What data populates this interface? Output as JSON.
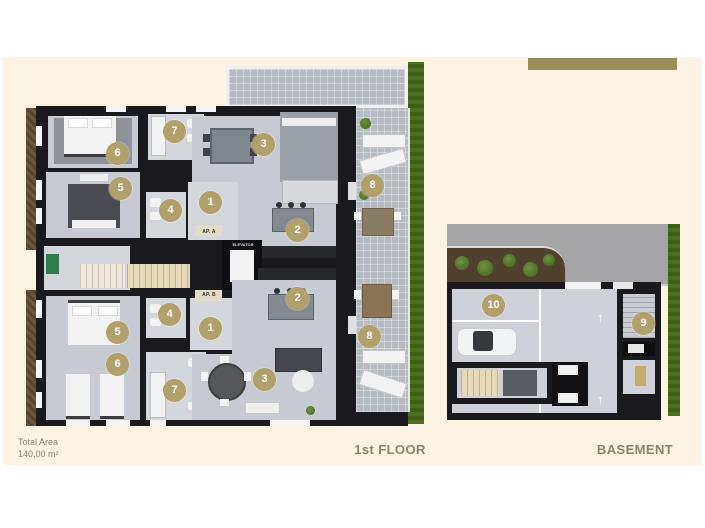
{
  "page": {
    "panel_color": "#fcf3e2",
    "accent_bar_color": "#9c8c5a",
    "marker_color": "#b1a06b"
  },
  "footer": {
    "total_area_label": "Total Area",
    "total_area_value": "140,00 m²"
  },
  "floor1": {
    "name_label": "1st FLOOR",
    "apartment_a_label": "AP. A",
    "apartment_b_label": "AP. B",
    "elevator_label": "ELEVATOR",
    "markers": [
      "6",
      "7",
      "3",
      "5",
      "4",
      "1",
      "2",
      "8",
      "4",
      "1",
      "5",
      "6",
      "7",
      "2",
      "3",
      "8"
    ]
  },
  "basement": {
    "name_label": "BASEMENT",
    "markers": [
      "10",
      "9"
    ],
    "direction_arrow": "↑"
  },
  "colors": {
    "wall": "#1a1a1e",
    "room_floor": "#c7cad1",
    "terrace_floor": "#b6bac1",
    "road": "#a5a5a7",
    "hedge_green": "#4c7020",
    "planting_soil": "#57432f",
    "stairs_beige": "#e6d9ba"
  }
}
